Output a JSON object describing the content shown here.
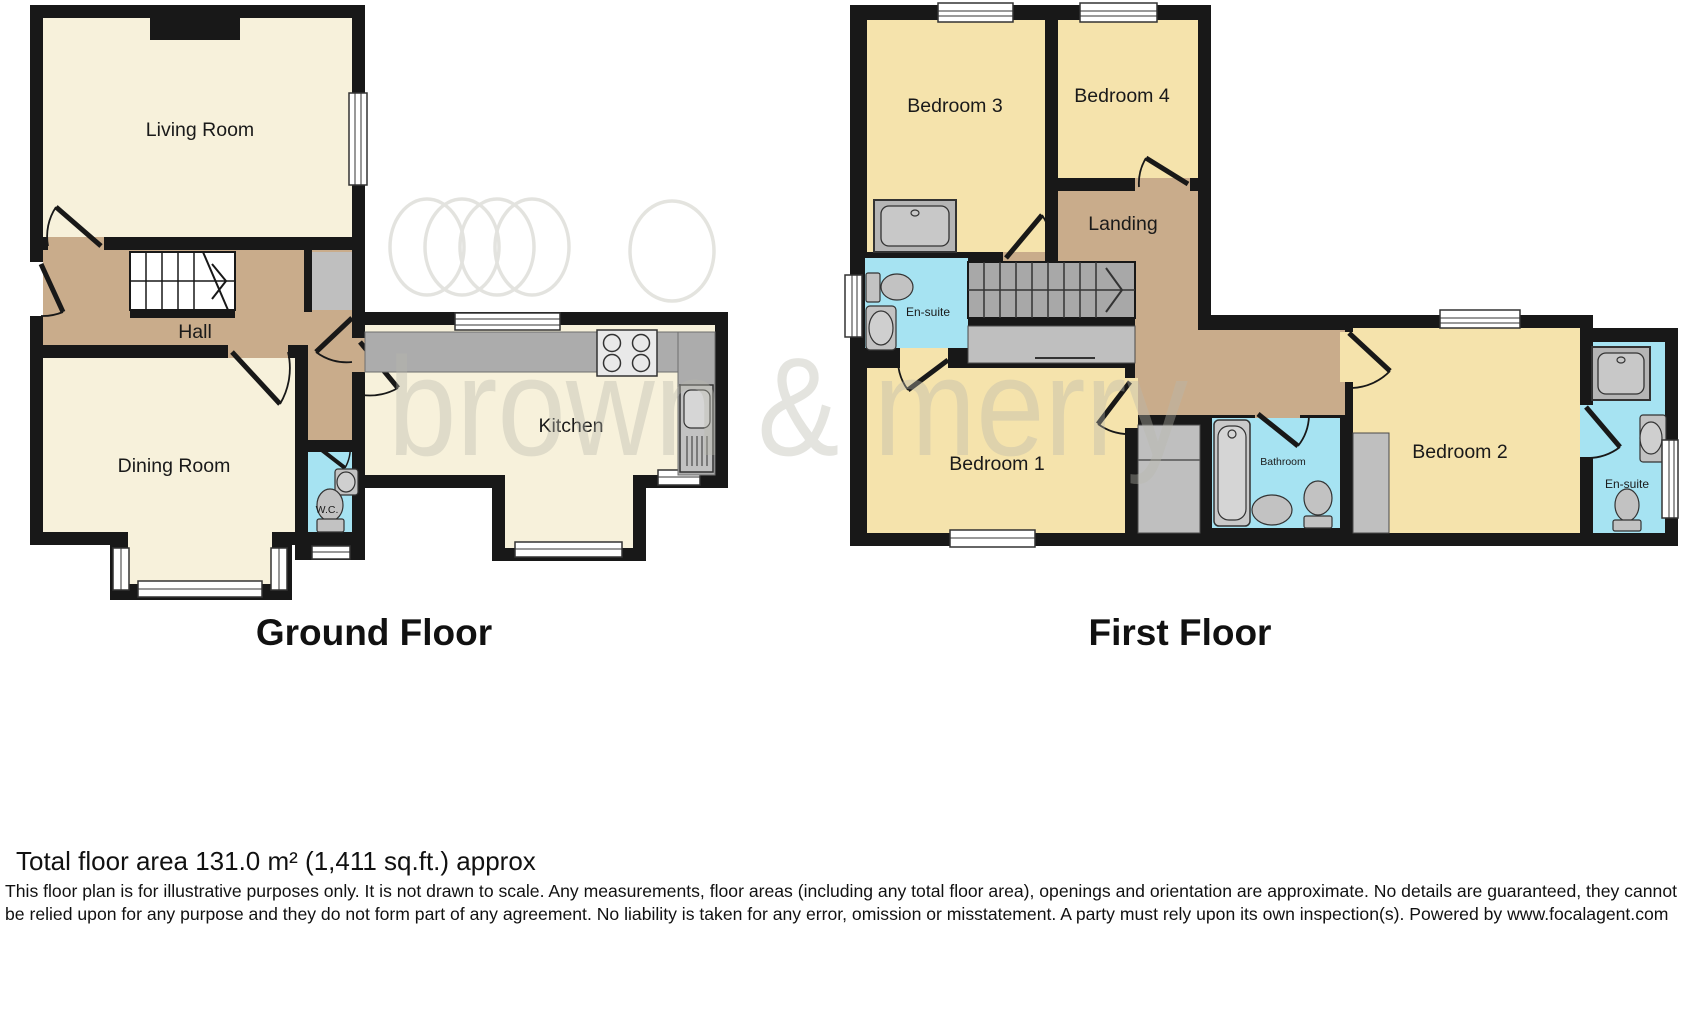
{
  "watermark": {
    "text": "brown & merry"
  },
  "ground_floor": {
    "title": "Ground Floor",
    "rooms": {
      "living_room": "Living Room",
      "hall": "Hall",
      "dining_room": "Dining Room",
      "wc": "W.C.",
      "kitchen": "Kitchen"
    }
  },
  "first_floor": {
    "title": "First Floor",
    "rooms": {
      "bedroom3": "Bedroom 3",
      "bedroom4": "Bedroom 4",
      "landing": "Landing",
      "ensuite_left": "En-suite",
      "bedroom1": "Bedroom 1",
      "bathroom": "Bathroom",
      "bedroom2": "Bedroom 2",
      "ensuite_right": "En-suite"
    }
  },
  "footer": {
    "total_area": "Total floor area 131.0 m² (1,411 sq.ft.) approx",
    "disclaimer": "This floor plan is for illustrative purposes only. It is not drawn to scale. Any measurements, floor areas (including any total floor area), openings and orientation are approximate. No details are guaranteed, they cannot be relied upon for any purpose and they do not form part of any agreement. No liability is taken for any error, omission or misstatement. A party must rely upon its own inspection(s). Powered by www.focalagent.com"
  },
  "colors": {
    "wall": "#181818",
    "ground_room_fill": "#f7f1db",
    "first_room_fill": "#f5e3ac",
    "hall_fill": "#c9ac8b",
    "bath_fill": "#a6e3f2",
    "counter_gray": "#acacac",
    "cupboard_gray": "#bfbfbf",
    "stairs_gray": "#a8a8a8",
    "fixture_gray": "#c2c2c2"
  }
}
